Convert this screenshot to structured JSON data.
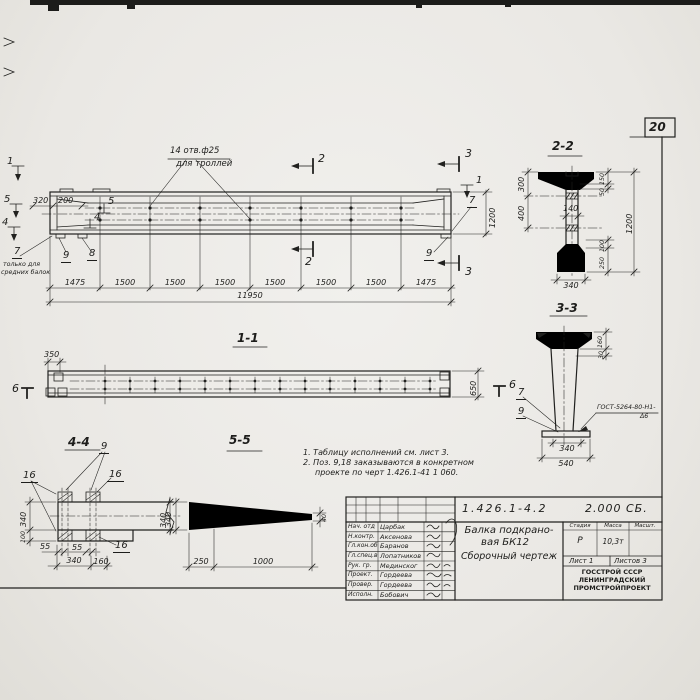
{
  "page_number": "20",
  "main_view": {
    "holes_note_line1": "14 отв.ф25",
    "holes_note_line2": "для троллей",
    "dim_320": "320",
    "dim_200": "200",
    "pos_left_1": "1",
    "pos_left_5": "5",
    "pos_left_4": "4",
    "pos_inner_5": "5",
    "pos_inner_4": "4",
    "pos_7": "7",
    "pos_7_note_line1": "только для",
    "pos_7_note_line2": "средних балок",
    "pos_9_left": "9",
    "pos_8": "8",
    "cut_2": "2",
    "cut_3": "3",
    "pos_right_1": "1",
    "pos_right_7": "7",
    "pos_right_9": "9",
    "dim_height": "1200",
    "dims_segments": [
      "1475",
      "1500",
      "1500",
      "1500",
      "1500",
      "1500",
      "1500",
      "1475"
    ],
    "dim_overall": "11950"
  },
  "view_1_1": {
    "title": "1-1",
    "dim_350": "350",
    "dim_650": "650",
    "mark_left": "6",
    "mark_right": "6"
  },
  "section_2_2": {
    "title": "2-2",
    "dim_300": "300",
    "dim_400": "400",
    "dim_140": "140",
    "dim_150": "150",
    "dim_50": "50",
    "dim_1200": "1200",
    "dim_100": "100",
    "dim_250": "250",
    "dim_340": "340"
  },
  "section_3_3": {
    "title": "3-3",
    "dim_160": "160",
    "dim_30": "30",
    "pos_7": "7",
    "pos_9": "9",
    "weld_note_line1": "ГОСТ-5264-80-Н1-",
    "weld_note_line2": "Δ6",
    "dim_340": "340",
    "dim_540": "540"
  },
  "section_4_4": {
    "title": "4-4",
    "pos_9": "9",
    "pos_16_a": "16",
    "pos_16_b": "16",
    "pos_16_c": "16",
    "dim_340_left": "340",
    "dim_100": "100",
    "dim_55_a": "55",
    "dim_55_b": "55",
    "dim_340_bottom": "340",
    "dim_160": "160",
    "dim_340_right": "340"
  },
  "section_5_5": {
    "title": "5-5",
    "dim_340": "340",
    "dim_40": "40",
    "dim_250": "250",
    "dim_1000": "1000"
  },
  "notes": {
    "line1": "1. Таблицу исполнений см. лист 3.",
    "line2": "2. Поз. 9,18 заказываются в конкретном",
    "line3": "проекте по черт 1.426.1-41 1 060."
  },
  "title_block": {
    "designation": "1.426.1-4.2",
    "doc_type": "2.000 СБ.",
    "title_line1": "Балка подкрано-",
    "title_line2": "вая БК12",
    "title_line3": "Сборочный  чертеж",
    "col_stage": "Стадия",
    "col_mass": "Масса",
    "col_scale": "Масшт.",
    "stage_value": "Р",
    "mass_value": "10,3т",
    "sheet_label": "Лист 1",
    "sheets_label": "Листов 3",
    "org_line1": "ГОССТРОЙ СССР",
    "org_line2": "ЛЕНИНГРАДСКИЙ",
    "org_line3": "ПРОМСТРОЙПРОЕКТ",
    "rows": [
      {
        "role": "Нач. отд",
        "name": "Царбак"
      },
      {
        "role": "Н.контр.",
        "name": "Аксенова"
      },
      {
        "role": "Гл.кон.об",
        "name": "Баранов"
      },
      {
        "role": "Гл.спец.в",
        "name": "Лопатников"
      },
      {
        "role": "Рук. гр.",
        "name": "Мединског"
      },
      {
        "role": "Проект.",
        "name": "Гордеева"
      },
      {
        "role": "Провер.",
        "name": "Гордеева"
      },
      {
        "role": "Исполн.",
        "name": "Бобович"
      }
    ]
  }
}
